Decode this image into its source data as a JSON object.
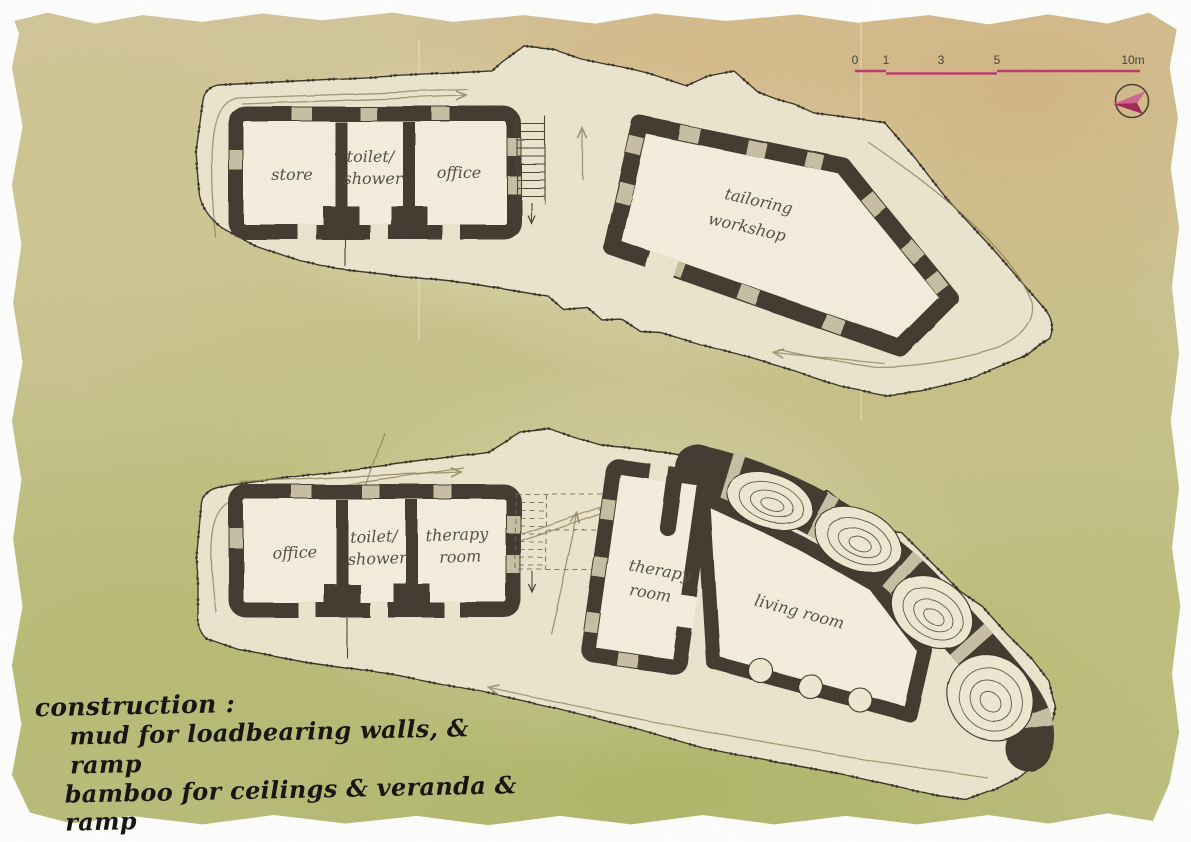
{
  "palette": {
    "wash_base": "#cfc795",
    "plan_fill": "#ece6d0",
    "room_fill": "#f4efdf",
    "wall_dark": "#453e31",
    "wall_window": "#c9c0a6",
    "outline": "#3d382c",
    "guide_olive": "#8d7f55",
    "scale_magenta": "#bb3f72",
    "ink": "#171610",
    "pencil": "#57524b"
  },
  "scale_bar": {
    "ticks": [
      "0",
      "1",
      "3",
      "5",
      "10m"
    ]
  },
  "compass": {
    "icon": "north-arrow"
  },
  "plan_upper": {
    "rooms": {
      "store": "store",
      "toilet_line1": "toilet/",
      "toilet_line2": "shower",
      "office": "office",
      "workshop_line1": "tailoring",
      "workshop_line2": "workshop"
    }
  },
  "plan_lower": {
    "rooms": {
      "office": "office",
      "toilet_line1": "toilet/",
      "toilet_line2": "shower",
      "therapy_a_line1": "therapy",
      "therapy_a_line2": "room",
      "therapy_b_line1": "therapy",
      "therapy_b_line2": "room",
      "living": "living room"
    }
  },
  "notes": {
    "title": "construction :",
    "line1": "mud for loadbearing walls, & ramp",
    "line2": "bamboo for ceilings & veranda & ramp"
  }
}
